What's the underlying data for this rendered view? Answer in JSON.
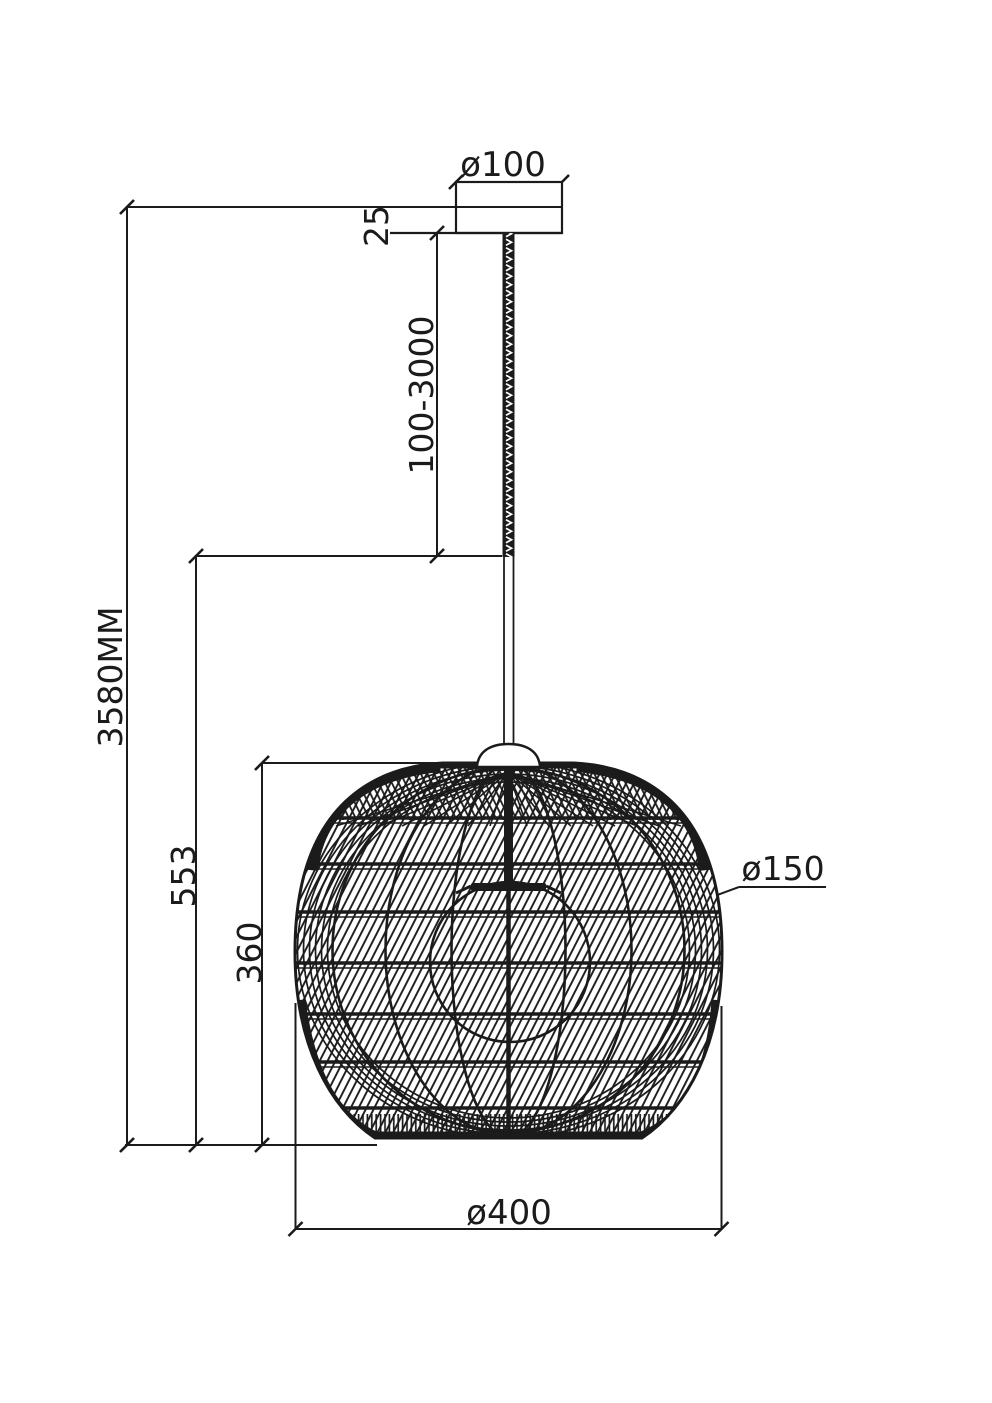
{
  "drawing": {
    "type": "technical-dimension-drawing",
    "subject": "rattan ball pendant lamp",
    "units": "mm",
    "ink_color": "#1b1b1b",
    "background_color": "#ffffff",
    "labels": {
      "canopy_diameter": "ø100",
      "canopy_height": "25",
      "cable_length_range": "100-3000",
      "overall_height": "3580MM",
      "drop_height": "553",
      "shade_height": "360",
      "bulb_diameter": "ø150",
      "shade_diameter": "ø400"
    }
  }
}
